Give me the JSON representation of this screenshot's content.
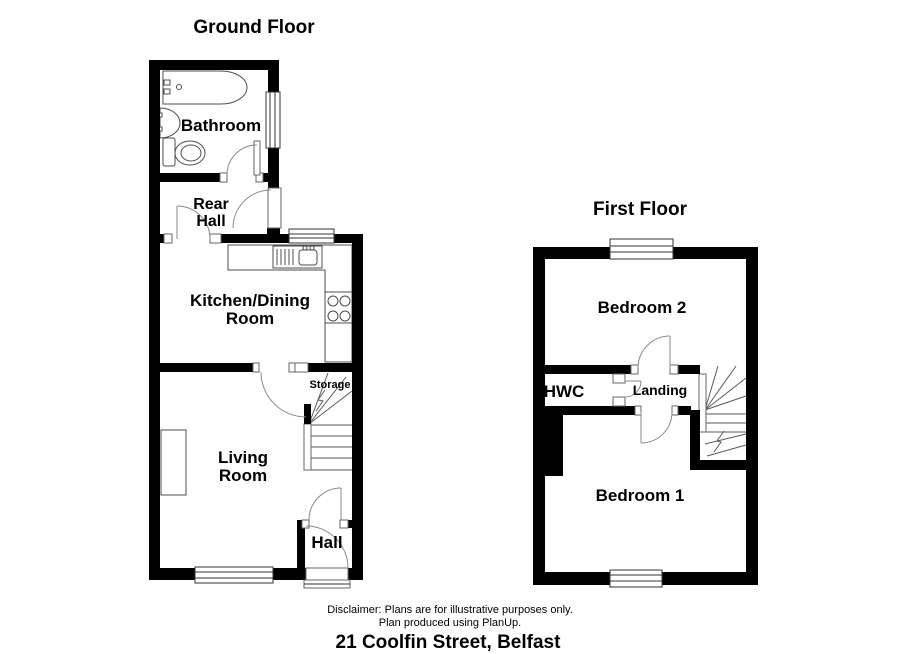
{
  "page": {
    "background": "#ffffff",
    "wall_color": "#000000",
    "line_color": "#4d4d4d",
    "door_arc_color": "#8a8a8a"
  },
  "ground_floor": {
    "title": "Ground Floor",
    "rooms": {
      "bathroom": "Bathroom",
      "rear_hall_line1": "Rear",
      "rear_hall_line2": "Hall",
      "kitchen_line1": "Kitchen/Dining",
      "kitchen_line2": "Room",
      "living_line1": "Living",
      "living_line2": "Room",
      "storage": "Storage",
      "hall": "Hall"
    }
  },
  "first_floor": {
    "title": "First Floor",
    "rooms": {
      "bedroom2": "Bedroom 2",
      "hwc": "HWC",
      "landing": "Landing",
      "bedroom1": "Bedroom 1"
    }
  },
  "footer": {
    "disclaimer_line1": "Disclaimer: Plans are for illustrative purposes only.",
    "disclaimer_line2": "Plan produced using PlanUp.",
    "address": "21 Coolfin Street, Belfast"
  }
}
